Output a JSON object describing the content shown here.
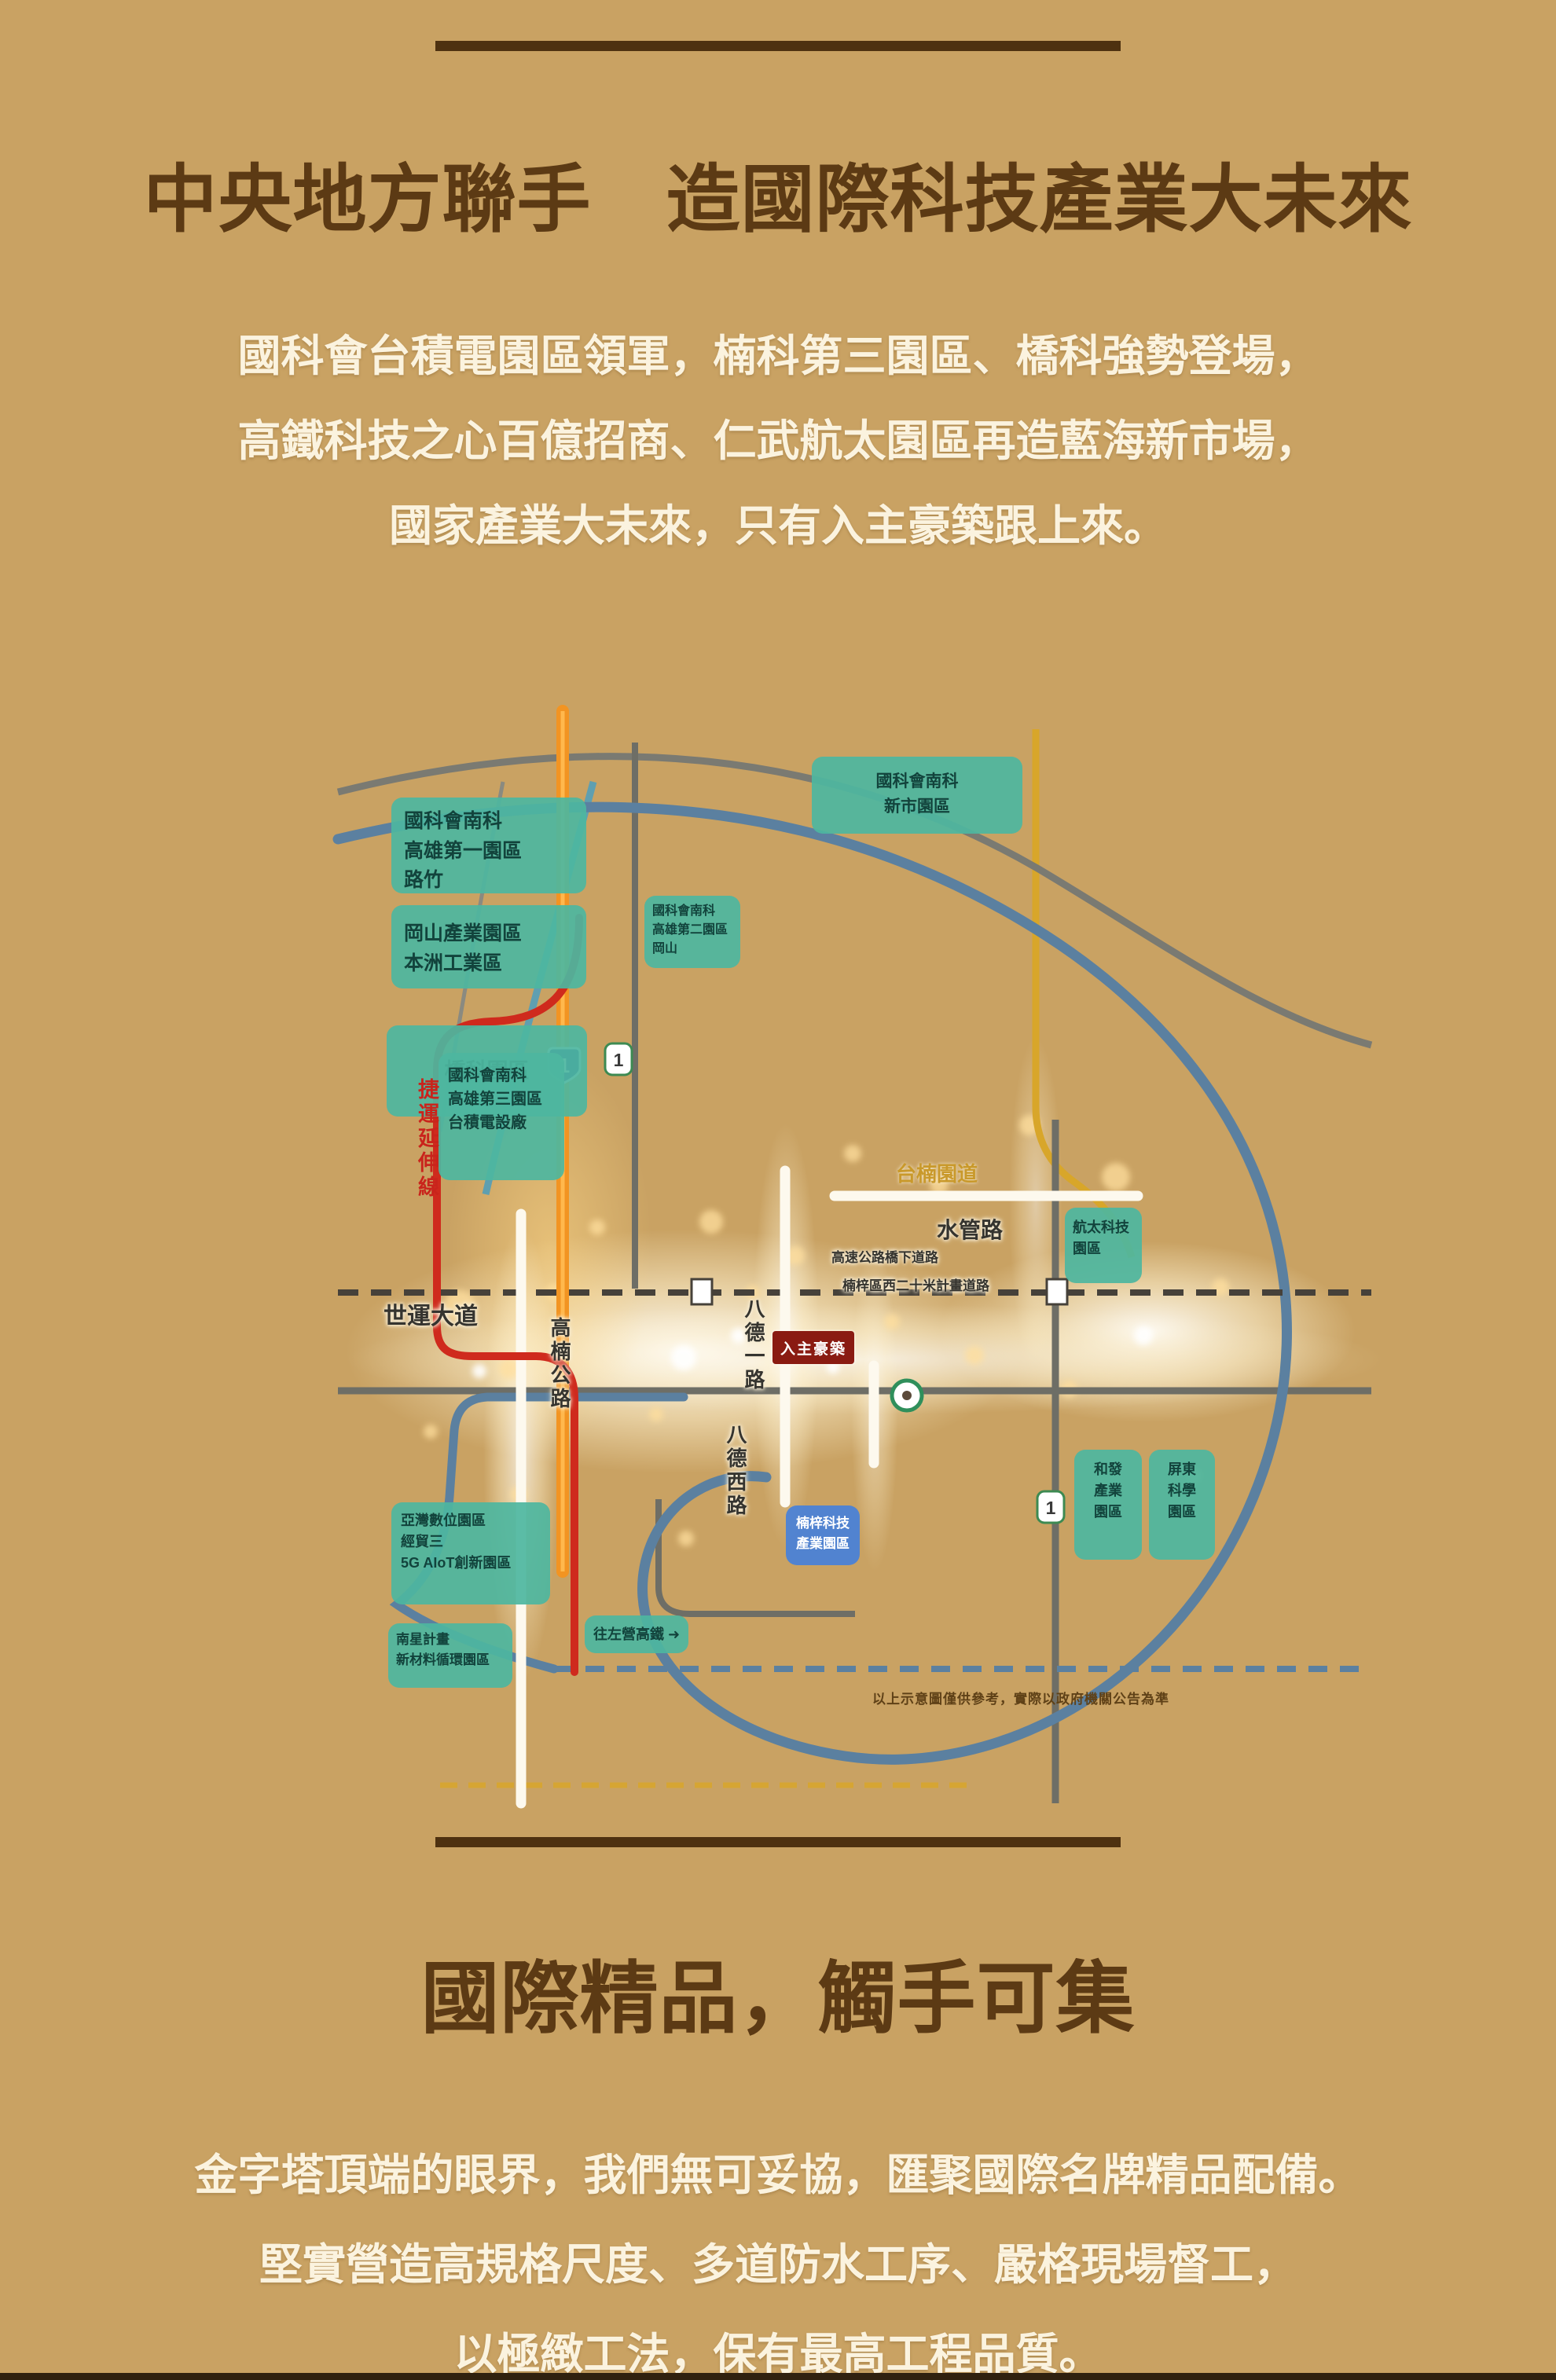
{
  "top": {
    "heading": "中央地方聯手　造國際科技產業大未來",
    "para": [
      "國科會台積電園區領軍，楠科第三園區、橋科強勢登場，",
      "高鐵科技之心百億招商、仁武航太園區再造藍海新市場，",
      "國家產業大未來，只有入主豪築跟上來。"
    ]
  },
  "map": {
    "p0": {
      "l1": "國科會南科",
      "l2": "新市園區"
    },
    "p1": {
      "l1": "國科會南科",
      "l2": "高雄第一園區",
      "l3": "路竹"
    },
    "p2": {
      "l1": "岡山產業園區",
      "l2": "本洲工業區"
    },
    "p3": {
      "l1": "橋科園區"
    },
    "p4": {
      "l1": "國科會南科",
      "l2": "高雄第二園區",
      "l3": "岡山"
    },
    "p5": {
      "l1": "國科會南科",
      "l2": "高雄第三園區",
      "l3": "台積電設廠"
    },
    "p6": {
      "l1": "航太科技",
      "l2": "園區"
    },
    "p7": {
      "l1": "和發",
      "l2": "產業",
      "l3": "園區"
    },
    "p8": {
      "l1": "屏東",
      "l2": "科學",
      "l3": "園區"
    },
    "p9": {
      "l1": "亞灣數位園區",
      "l2": "經貿三",
      "l3": "5G AIoT創新園區"
    },
    "p10": {
      "l1": "南星計畫",
      "l2": "新材料循環園區"
    },
    "p11": {
      "l1": "往左營高鐵 ➜"
    },
    "p12": {
      "l1": "楠梓科技",
      "l2": "產業園區"
    },
    "labels": {
      "shiyun": "世運大道",
      "gaonan": "高楠公路",
      "bade1": "八德一路",
      "badexi": "八德西路",
      "shuiguan": "水管路",
      "taonan": "台楠園道",
      "under1": "高速公路橋下道路",
      "under2": "楠梓區西二十米計畫道路",
      "mrt": "捷運延伸線",
      "disclaimer": "以上示意圖僅供參考，實際以政府機關公告為準"
    },
    "badge": "入主豪築",
    "shields": {
      "a": "1",
      "b": "1",
      "c": "1"
    }
  },
  "bottom": {
    "heading": "國際精品，觸手可集",
    "para": [
      "金字塔頂端的眼界，我們無可妥協，匯聚國際名牌精品配備。",
      "堅實營造高規格尺度、多道防水工序、嚴格現場督工，",
      "以極緻工法，保有最高工程品質。"
    ]
  },
  "colors": {
    "background": "#c9a263",
    "heading": "#5c3a14",
    "rule": "#4e3110",
    "park_teal": "#4db6a0",
    "park_blue": "#4b82d6",
    "freeway_orange": "#f29422",
    "mrt_red": "#cf2a1d",
    "road_blue": "#5b80a0",
    "road_gold": "#d8a62a"
  }
}
